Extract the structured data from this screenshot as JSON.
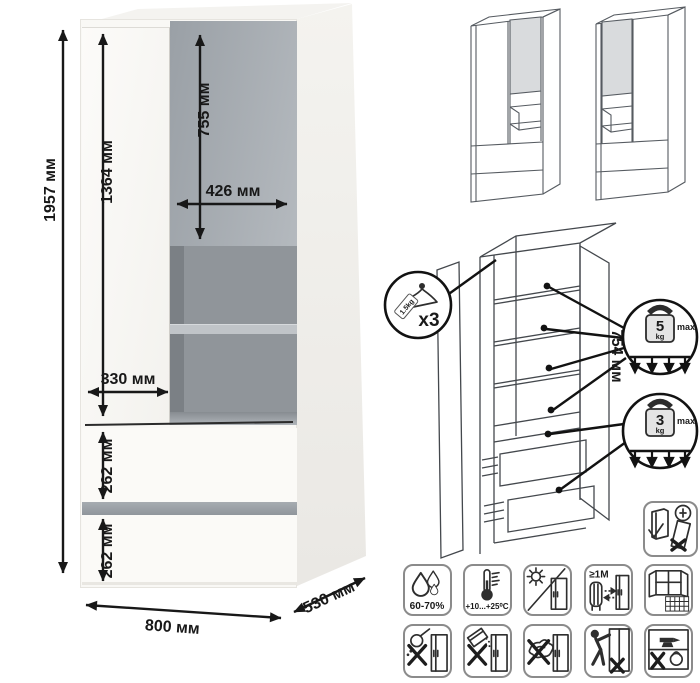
{
  "colors": {
    "dimension_ink": "#181818",
    "gray_door": "#a9aeb4",
    "niche_interior": "#90959a",
    "shelf_gray": "#c0c4c8",
    "drawer_gap_gray": "#9aa0a6",
    "outline_gray": "#565b61",
    "panel_gray": "#d9dbdd"
  },
  "main_view": {
    "dim_total_height": "1957 мм",
    "dim_left_door_height": "1364 мм",
    "dim_gray_door_height": "755 мм",
    "dim_gray_door_width": "426 мм",
    "dim_left_door_width": "330 мм",
    "dim_drawer_top_height": "262 мм",
    "dim_drawer_bottom_height": "262 мм",
    "dim_width": "800 мм",
    "dim_depth": "530 мм"
  },
  "exploded_view": {
    "dim_inner_height": "754 мм",
    "hanger": {
      "tag": "1.5kg",
      "qty": "x3"
    },
    "shelf_load": {
      "value": "5",
      "unit": "kg",
      "suffix": "max"
    },
    "drawer_load": {
      "value": "3",
      "unit": "kg",
      "suffix": "max"
    }
  },
  "care_icons": {
    "row1": [
      {
        "name": "humidity",
        "label": "60-70%"
      },
      {
        "name": "temperature",
        "label": "+10...+25⁰C"
      },
      {
        "name": "no-direct-sunlight",
        "label": ""
      },
      {
        "name": "radiator-distance",
        "label": "≥1M"
      },
      {
        "name": "ventilation-window",
        "label": ""
      }
    ],
    "row2": [
      {
        "name": "no-pouring-liquids"
      },
      {
        "name": "no-abrasive-powder"
      },
      {
        "name": "no-wet-cleaning"
      },
      {
        "name": "no-climbing-pulling"
      },
      {
        "name": "no-heavy-overload"
      }
    ],
    "anchor": {
      "name": "secure-to-wall-warning"
    }
  }
}
